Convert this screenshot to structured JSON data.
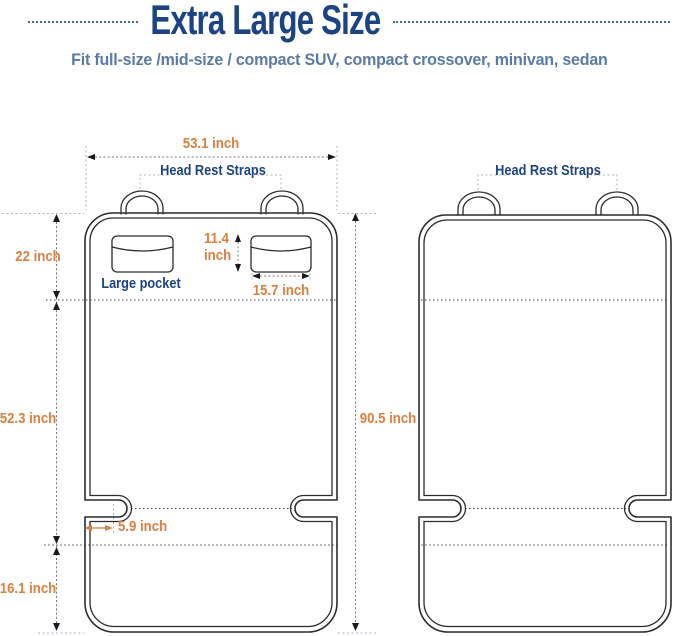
{
  "title": "Extra Large Size",
  "subtitle": "Fit full-size /mid-size / compact SUV, compact crossover, minivan, sedan",
  "colors": {
    "navy": "#1c4484",
    "steel": "#5b7ba6",
    "orange": "#dd7f3f",
    "outline": "#2c2c2c",
    "dimline": "#787878",
    "arrow": "#1a1a1a",
    "guide": "#a9b6c6",
    "bg": "#ffffff"
  },
  "left_diagram": {
    "labels": {
      "head_rest_straps": "Head Rest Straps",
      "large_pocket": "Large pocket"
    },
    "dims": {
      "width": "53.1 inch",
      "backrest_height": "22 inch",
      "pocket_height_value": "11.4",
      "pocket_height_unit": "inch",
      "pocket_width": "15.7 inch",
      "seat_length": "52.3 inch",
      "slot_depth": "5.9 inch",
      "front_drop": "16.1 inch"
    }
  },
  "right_diagram": {
    "labels": {
      "head_rest_straps": "Head Rest Straps"
    },
    "dims": {
      "total_height": "90.5 inch"
    }
  }
}
